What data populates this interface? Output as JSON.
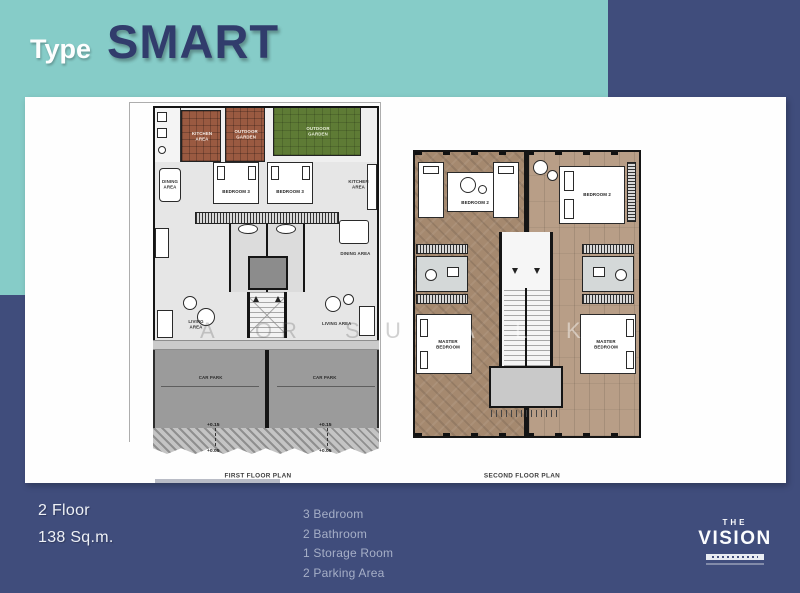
{
  "colors": {
    "background_navy": "#404D7C",
    "accent_teal": "#86CCC8",
    "title_navy": "#313C6C",
    "garden_green": "#5E7B35",
    "tile_brown": "#9A5A41"
  },
  "header": {
    "type_label": "Type",
    "model_name": "SMART"
  },
  "floor1": {
    "caption": "FIRST FLOOR PLAN",
    "rooms": {
      "kitchen_left": "KITCHEN AREA",
      "garden_brown": "OUTDOOR GARDEN",
      "garden_green": "OUTDOOR GARDEN",
      "dining_left": "DINING AREA",
      "bedroom_left": "BEDROOM 3",
      "bedroom_right": "BEDROOM 3",
      "kitchen_right": "KITCHEN AREA",
      "dining_right": "DINING AREA",
      "living_left": "LIVING AREA",
      "living_right": "LIVING AREA",
      "carpark_left": "CAR PARK",
      "carpark_right": "CAR PARK"
    },
    "elevation": {
      "upper": "+0.15",
      "lower": "+0.05"
    }
  },
  "floor2": {
    "caption": "SECOND FLOOR PLAN",
    "rooms": {
      "bedroom2_left": "BEDROOM 2",
      "bedroom2_right": "BEDROOM 2",
      "master_left": "MASTER BEDROOM",
      "master_right": "MASTER BEDROOM"
    }
  },
  "specs": {
    "floors": "2 Floor",
    "area": "138 Sq.m.",
    "items": [
      "3 Bedroom",
      "2 Bathroom",
      "1 Storage Room",
      "2 Parking Area"
    ]
  },
  "logo": {
    "the": "THE",
    "name": "VISION"
  },
  "watermark": {
    "letters": [
      "A",
      "O",
      "R",
      "S",
      "U",
      "A",
      "L",
      "K"
    ]
  }
}
